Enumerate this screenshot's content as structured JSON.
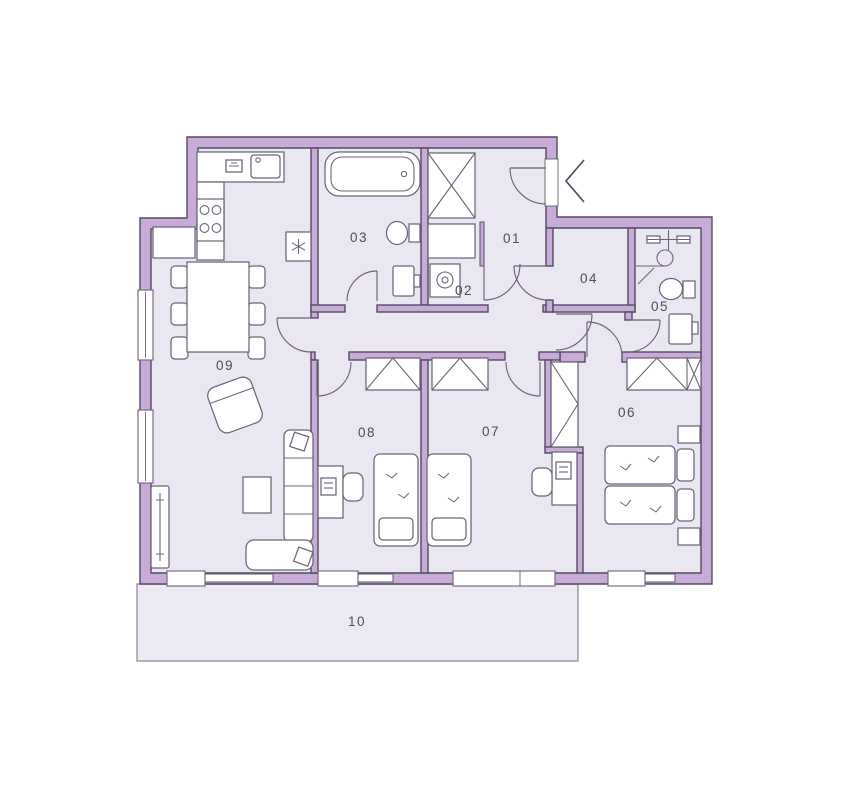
{
  "rooms": [
    {
      "id": "01",
      "label": "01"
    },
    {
      "id": "02",
      "label": "02"
    },
    {
      "id": "03",
      "label": "03"
    },
    {
      "id": "04",
      "label": "04"
    },
    {
      "id": "05",
      "label": "05"
    },
    {
      "id": "06",
      "label": "06"
    },
    {
      "id": "07",
      "label": "07"
    },
    {
      "id": "08",
      "label": "08"
    },
    {
      "id": "09",
      "label": "09"
    },
    {
      "id": "10",
      "label": "10"
    }
  ],
  "icons": {
    "entrance_arrow": "chevron-left",
    "fridge_snowflake": "asterisk-lines",
    "cooktop": "four-circles",
    "washer": "circle-in-square",
    "shower_head": "crossbar-and-circle"
  },
  "colors": {
    "wall": "#c9abda",
    "outline": "#534d60",
    "floor": "#eae6f2",
    "furn": "#6b6577",
    "label": "#4d4c57",
    "terrace_outline": "#97949f",
    "page_bg": "#ffffff"
  }
}
